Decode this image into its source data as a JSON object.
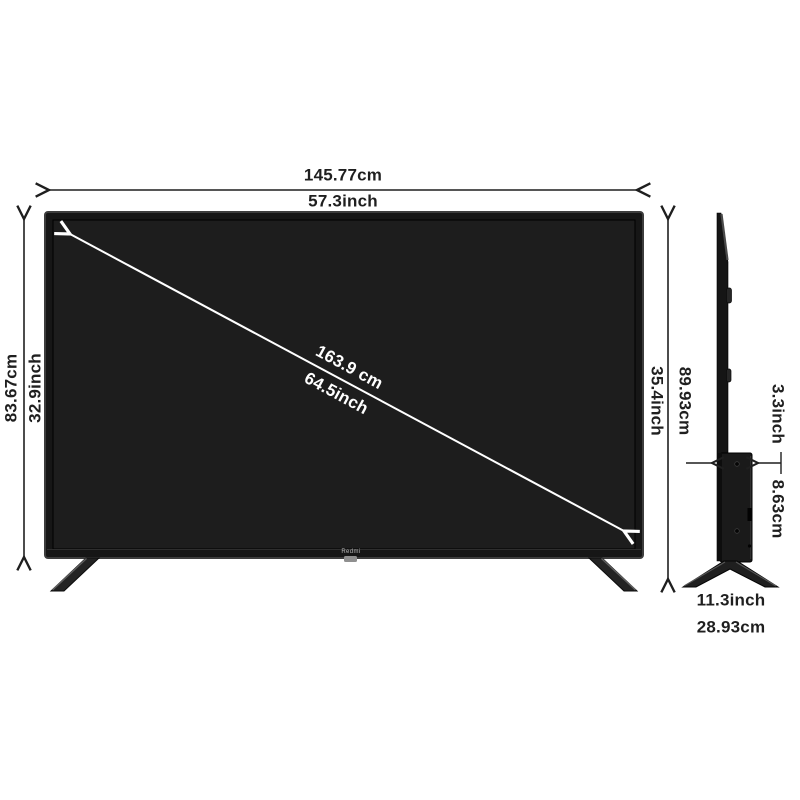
{
  "front_view": {
    "width_cm": "145.77cm",
    "width_inch": "57.3inch",
    "height_cm": "83.67cm",
    "height_inch": "32.9inch",
    "diagonal_cm": "163.9 cm",
    "diagonal_inch": "64.5inch",
    "brand_logo": "Redmi"
  },
  "side_view": {
    "height_cm": "89.93cm",
    "height_inch": "35.4inch",
    "depth_inch": "3.3inch",
    "depth_cm": "8.63cm",
    "stand_width_inch": "11.3inch",
    "stand_width_cm": "28.93cm"
  },
  "colors": {
    "background": "#ffffff",
    "dimension_text": "#1f1f1f",
    "dimension_line": "#1f1f1f",
    "diagonal_line": "#ffffff",
    "tv_bezel": "#161616",
    "tv_screen": "#1d1d1d"
  }
}
